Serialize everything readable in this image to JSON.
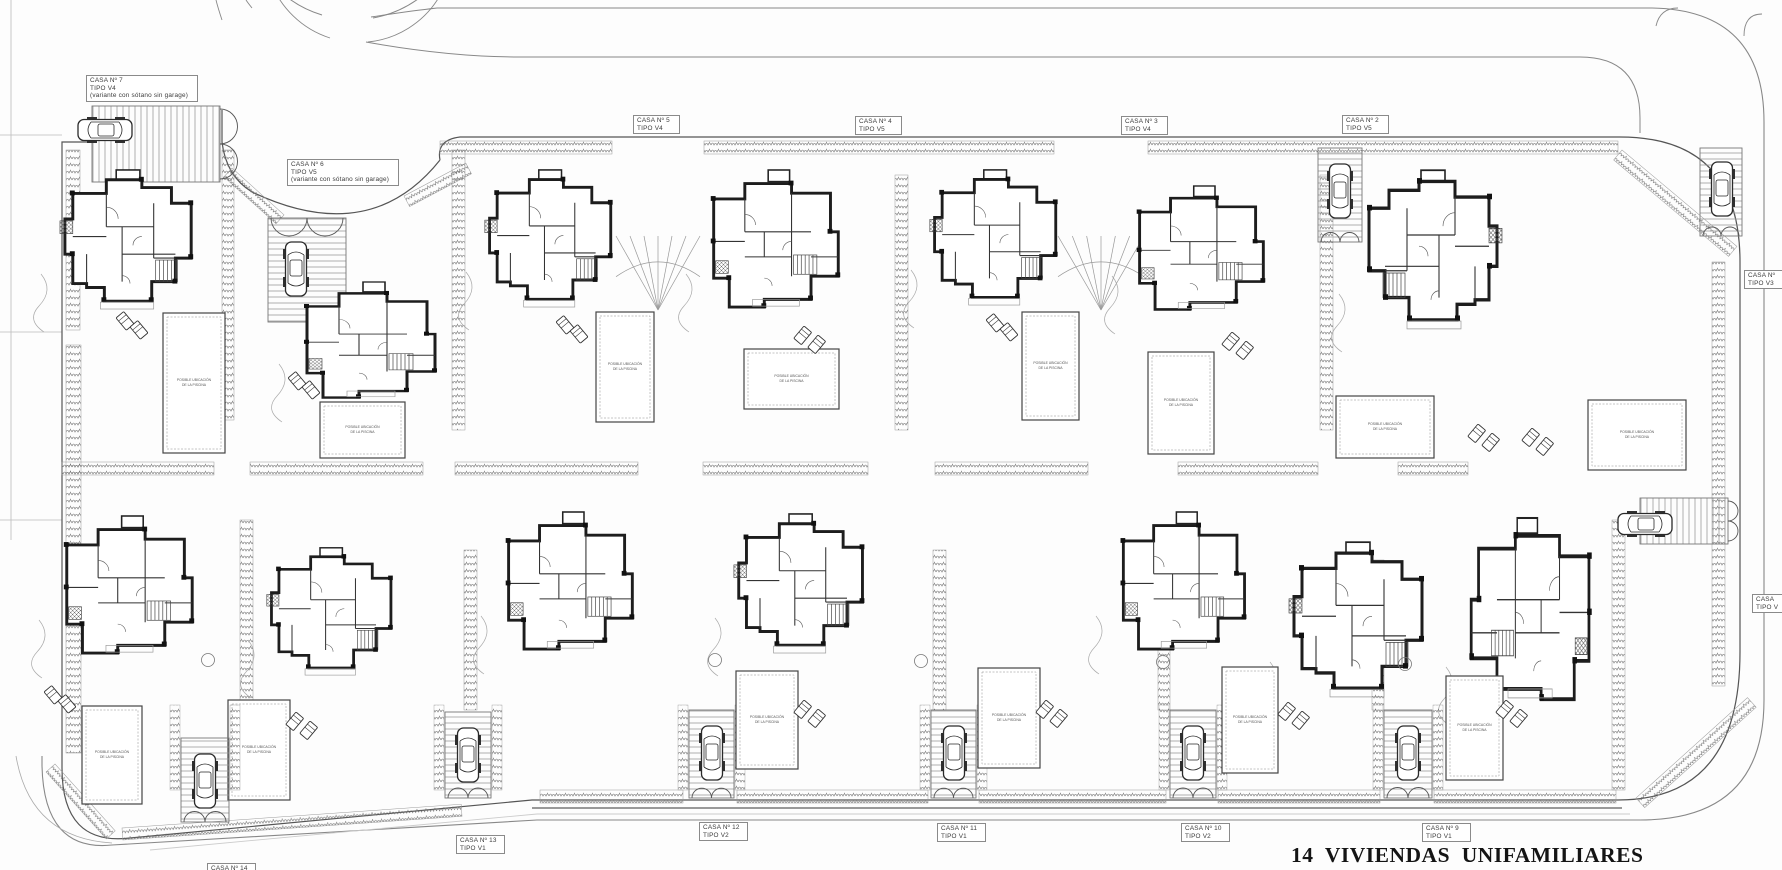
{
  "title": {
    "text": "14  VIVIENDAS  UNIFAMILIARES"
  },
  "pool_note": [
    "POSIBLE UBICACIÓN",
    "DE LA PISCINA"
  ],
  "colors": {
    "wall": "#1d1d1d",
    "line": "#555555",
    "hedge": "#6b6b6b",
    "road": "#888888",
    "faint": "#aaaaaa"
  },
  "trees": [
    [
      208,
      660
    ],
    [
      715,
      660
    ],
    [
      921,
      661
    ],
    [
      1163,
      662
    ],
    [
      1405,
      664
    ]
  ],
  "plots": [
    {
      "id": 1,
      "lines": [
        "CASA Nº",
        "TIPO V3"
      ],
      "label": {
        "x": 1744,
        "y": 270,
        "w": 44
      },
      "house": {
        "x": 1355,
        "y": 168,
        "w": 150,
        "h": 162,
        "v": "a",
        "flip": true
      },
      "pool": {
        "x": 1336,
        "y": 396,
        "w": 98,
        "h": 62
      },
      "loungers": {
        "x": 1478,
        "y": 424,
        "a": 40
      },
      "garage": {
        "x": 1700,
        "y": 148,
        "w": 42,
        "h": 88,
        "dir": "v",
        "gate": "bottom"
      },
      "car": {
        "x": 1710,
        "y": 160,
        "angle": 0
      }
    },
    {
      "id": 2,
      "lines": [
        "CASA Nº 2",
        "TIPO V5"
      ],
      "label": {
        "x": 1342,
        "y": 115,
        "w": 47
      },
      "house": {
        "x": 1128,
        "y": 186,
        "w": 145,
        "h": 126,
        "v": "b"
      },
      "pool": {
        "x": 1148,
        "y": 352,
        "w": 66,
        "h": 102
      },
      "loungers": {
        "x": 1232,
        "y": 332,
        "a": 40
      },
      "garage": {
        "x": 1318,
        "y": 148,
        "w": 44,
        "h": 94,
        "dir": "v",
        "gate": "bottom"
      },
      "car": {
        "x": 1328,
        "y": 162,
        "angle": 0
      },
      "fan": {
        "x": 1058,
        "y": 236,
        "w": 86,
        "h": 74
      }
    },
    {
      "id": 3,
      "lines": [
        "CASA Nº 3",
        "TIPO V4"
      ],
      "label": {
        "x": 1121,
        "y": 116,
        "w": 47
      },
      "house": {
        "x": 927,
        "y": 168,
        "w": 142,
        "h": 138,
        "v": "a"
      },
      "pool": {
        "x": 1022,
        "y": 312,
        "w": 57,
        "h": 108
      },
      "loungers": {
        "x": 986,
        "y": 320,
        "a": -40
      }
    },
    {
      "id": 4,
      "lines": [
        "CASA Nº 4",
        "TIPO V5"
      ],
      "label": {
        "x": 855,
        "y": 116,
        "w": 47
      },
      "house": {
        "x": 702,
        "y": 170,
        "w": 146,
        "h": 140,
        "v": "b"
      },
      "pool": {
        "x": 744,
        "y": 349,
        "w": 95,
        "h": 60
      },
      "loungers": {
        "x": 804,
        "y": 326,
        "a": 40
      },
      "fan": {
        "x": 616,
        "y": 236,
        "w": 84,
        "h": 74
      }
    },
    {
      "id": 5,
      "lines": [
        "CASA Nº 5",
        "TIPO V4"
      ],
      "label": {
        "x": 633,
        "y": 115,
        "w": 47
      },
      "house": {
        "x": 482,
        "y": 168,
        "w": 142,
        "h": 140,
        "v": "a"
      },
      "pool": {
        "x": 596,
        "y": 312,
        "w": 58,
        "h": 110
      },
      "loungers": {
        "x": 556,
        "y": 322,
        "a": -40
      }
    },
    {
      "id": 6,
      "lines": [
        "CASA Nº 6",
        "TIPO V5",
        "(variante con sótano sin garage)"
      ],
      "label": {
        "x": 287,
        "y": 159,
        "w": 112
      },
      "house": {
        "x": 295,
        "y": 282,
        "w": 150,
        "h": 118,
        "v": "b"
      },
      "pool": {
        "x": 320,
        "y": 402,
        "w": 85,
        "h": 56
      },
      "loungers": {
        "x": 288,
        "y": 378,
        "a": -40
      },
      "garage": {
        "x": 268,
        "y": 218,
        "w": 78,
        "h": 104,
        "dir": "v",
        "gate": "top"
      },
      "car": {
        "x": 284,
        "y": 240,
        "angle": 0
      }
    },
    {
      "id": 7,
      "lines": [
        "CASA Nº 7",
        "TIPO V4",
        "(variante con sótano sin garage)"
      ],
      "label": {
        "x": 86,
        "y": 75,
        "w": 112
      },
      "house": {
        "x": 57,
        "y": 168,
        "w": 148,
        "h": 142,
        "v": "a"
      },
      "pool": {
        "x": 163,
        "y": 313,
        "w": 62,
        "h": 140
      },
      "loungers": {
        "x": 116,
        "y": 318,
        "a": -40
      },
      "garage": {
        "x": 92,
        "y": 106,
        "w": 128,
        "h": 76,
        "dir": "h",
        "gate": "right"
      },
      "car": {
        "x": 110,
        "y": 118,
        "angle": 90
      }
    },
    {
      "id": 8,
      "lines": [
        "CASA",
        "TIPO V"
      ],
      "label": {
        "x": 1752,
        "y": 594,
        "w": 38
      },
      "house": {
        "x": 1462,
        "y": 518,
        "w": 138,
        "h": 185,
        "v": "b",
        "flip": true
      },
      "pool": {
        "x": 1588,
        "y": 400,
        "w": 98,
        "h": 70
      },
      "loungers": {
        "x": 1532,
        "y": 428,
        "a": 40
      },
      "garage": {
        "x": 1640,
        "y": 498,
        "w": 88,
        "h": 46,
        "dir": "h",
        "gate": "right"
      },
      "car": {
        "x": 1650,
        "y": 512,
        "angle": 90
      }
    },
    {
      "id": 9,
      "lines": [
        "CASA Nº 9",
        "TIPO V1"
      ],
      "label": {
        "x": 1422,
        "y": 823,
        "w": 49
      },
      "house": {
        "x": 1286,
        "y": 540,
        "w": 150,
        "h": 158,
        "v": "a"
      },
      "pool": {
        "x": 1446,
        "y": 676,
        "w": 57,
        "h": 104
      },
      "loungers": {
        "x": 1506,
        "y": 700,
        "a": 40
      },
      "garage": {
        "x": 1384,
        "y": 710,
        "w": 48,
        "h": 88,
        "dir": "v",
        "gate": "bottom"
      },
      "car": {
        "x": 1396,
        "y": 724,
        "angle": 0
      }
    },
    {
      "id": 10,
      "lines": [
        "CASA Nº 10",
        "TIPO V2"
      ],
      "label": {
        "x": 1181,
        "y": 823,
        "w": 49
      },
      "house": {
        "x": 1112,
        "y": 512,
        "w": 142,
        "h": 140,
        "v": "b"
      },
      "pool": {
        "x": 1222,
        "y": 667,
        "w": 56,
        "h": 106
      },
      "loungers": {
        "x": 1288,
        "y": 702,
        "a": 40
      },
      "garage": {
        "x": 1170,
        "y": 710,
        "w": 46,
        "h": 88,
        "dir": "v",
        "gate": "bottom"
      },
      "car": {
        "x": 1181,
        "y": 724,
        "angle": 0
      }
    },
    {
      "id": 11,
      "lines": [
        "CASA Nº 11",
        "TIPO V1"
      ],
      "label": {
        "x": 937,
        "y": 823,
        "w": 49
      },
      "house": {
        "x": 731,
        "y": 512,
        "w": 145,
        "h": 142,
        "v": "a"
      },
      "pool": {
        "x": 978,
        "y": 668,
        "w": 62,
        "h": 100
      },
      "loungers": {
        "x": 1046,
        "y": 700,
        "a": 40
      },
      "garage": {
        "x": 931,
        "y": 710,
        "w": 45,
        "h": 88,
        "dir": "v",
        "gate": "bottom"
      },
      "car": {
        "x": 942,
        "y": 724,
        "angle": 0
      }
    },
    {
      "id": 12,
      "lines": [
        "CASA Nº 12",
        "TIPO V2"
      ],
      "label": {
        "x": 699,
        "y": 822,
        "w": 49
      },
      "house": {
        "x": 497,
        "y": 512,
        "w": 145,
        "h": 140,
        "v": "b"
      },
      "pool": {
        "x": 736,
        "y": 671,
        "w": 62,
        "h": 98
      },
      "loungers": {
        "x": 804,
        "y": 700,
        "a": 40
      },
      "garage": {
        "x": 689,
        "y": 710,
        "w": 45,
        "h": 88,
        "dir": "v",
        "gate": "bottom"
      },
      "car": {
        "x": 700,
        "y": 724,
        "angle": 0
      }
    },
    {
      "id": 13,
      "lines": [
        "CASA Nº 13",
        "TIPO V1"
      ],
      "label": {
        "x": 456,
        "y": 835,
        "w": 49
      },
      "house": {
        "x": 264,
        "y": 546,
        "w": 140,
        "h": 130,
        "v": "a"
      },
      "pool": {
        "x": 228,
        "y": 700,
        "w": 62,
        "h": 100
      },
      "loungers": {
        "x": 296,
        "y": 712,
        "a": 40
      },
      "garage": {
        "x": 445,
        "y": 712,
        "w": 46,
        "h": 86,
        "dir": "v",
        "gate": "bottom"
      },
      "car": {
        "x": 456,
        "y": 726,
        "angle": 0
      }
    },
    {
      "id": 14,
      "lines": [
        "CASA Nº 14"
      ],
      "label": {
        "x": 207,
        "y": 863,
        "w": 49
      },
      "house": {
        "x": 55,
        "y": 516,
        "w": 147,
        "h": 140,
        "v": "b"
      },
      "pool": {
        "x": 82,
        "y": 706,
        "w": 60,
        "h": 98
      },
      "loungers": {
        "x": 44,
        "y": 692,
        "a": -40
      },
      "garage": {
        "x": 181,
        "y": 738,
        "w": 48,
        "h": 84,
        "dir": "v",
        "gate": "bottom"
      },
      "car": {
        "x": 193,
        "y": 752,
        "angle": 0
      }
    }
  ]
}
